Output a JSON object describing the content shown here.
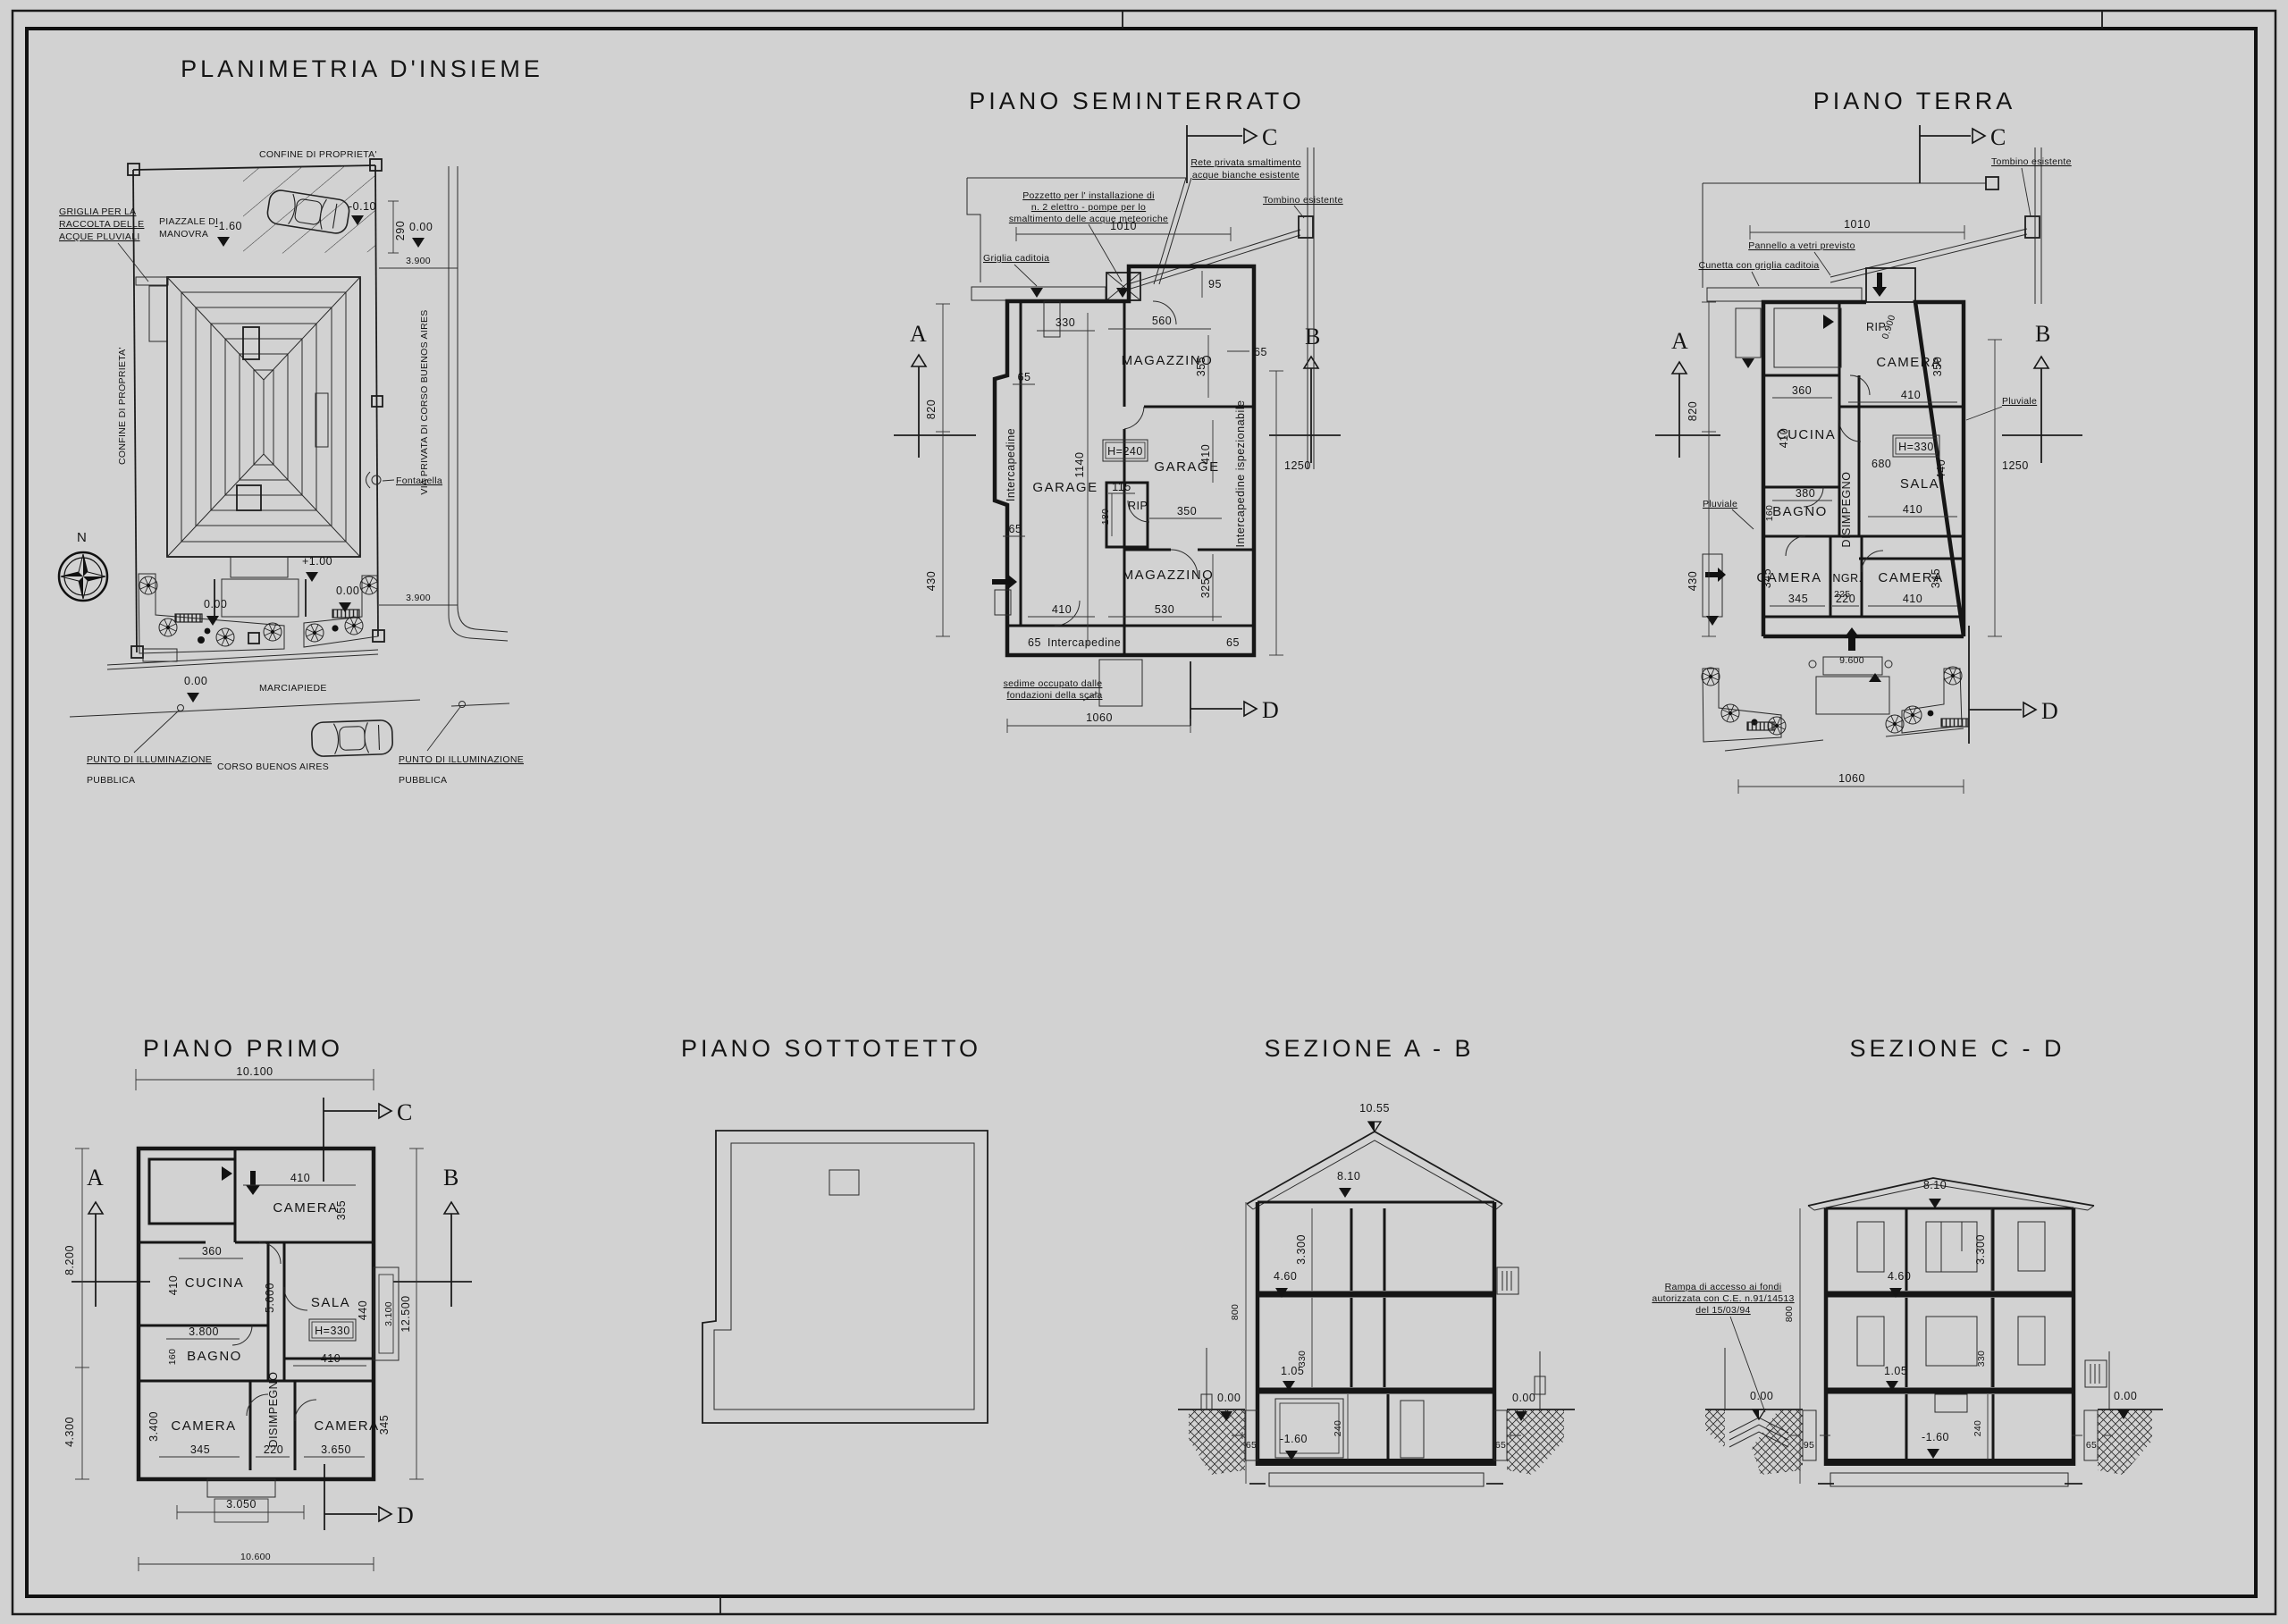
{
  "sheet": {
    "background": "#d2d2d2",
    "ink": "#1a1a1a"
  },
  "site": {
    "title": "PLANIMETRIA D'INSIEME",
    "north": "N",
    "sec": {},
    "notes": {
      "griglia1": "GRIGLIA PER LA",
      "griglia2": "RACCOLTA DELLE",
      "griglia3": "ACQUE PLUVIALI",
      "confine_top": "CONFINE DI PROPRIETA'",
      "confine_left": "CONFINE DI PROPRIETA'",
      "piazzale1": "PIAZZALE DI",
      "piazzale2": "MANOVRA",
      "via_privata": "VIA PRIVATA DI CORSO BUENOS AIRES",
      "fontanella": "Fontanella",
      "marciapiede": "MARCIAPIEDE",
      "corso": "CORSO BUENOS AIRES",
      "punto_ill": "PUNTO DI ILLUMINAZIONE",
      "pubblica": "PUBBLICA"
    },
    "levels": {
      "m160": "-1.60",
      "m010": "-0.10",
      "zero": "0.00",
      "p100": "+1.00"
    },
    "dims": {
      "d290": "290",
      "d3900": "3.900"
    }
  },
  "basement": {
    "title": "PIANO SEMINTERRATO",
    "sec": {
      "a": "A",
      "b": "B",
      "c": "C",
      "d": "D"
    },
    "rooms": {
      "garage1": "GARAGE",
      "garage2": "GARAGE",
      "magazzino1": "MAGAZZINO",
      "magazzino2": "MAGAZZINO",
      "rip": "RIP.",
      "h": "H=240"
    },
    "notes": {
      "rete1": "Rete privata smaltimento",
      "rete2": "acque bianche esistente",
      "pozzetto1": "Pozzetto per l' installazione di",
      "pozzetto2": "n. 2 elettro - pompe per lo",
      "pozzetto3": "smaltimento delle acque meteoriche",
      "tombino": "Tombino esistente",
      "griglia": "Griglia caditoia",
      "sedime1": "sedime occupato dalle",
      "sedime2": "fondazioni della scala",
      "intercapedine": "Intercapedine",
      "intercapedine_isp": "Intercapedine ispezionabile"
    },
    "dims": {
      "d1010": "1010",
      "d95": "95",
      "d330": "330",
      "d560": "560",
      "d65": "65",
      "d355": "355",
      "d820": "820",
      "d430": "430",
      "d1140": "1140",
      "d410": "410",
      "d115": "115",
      "d180": "180",
      "d350": "350",
      "d325": "325",
      "d530": "530",
      "d1250": "1250",
      "d1060": "1060"
    }
  },
  "ground": {
    "title": "PIANO TERRA",
    "sec": {
      "a": "A",
      "b": "B",
      "c": "C",
      "d": "D"
    },
    "rooms": {
      "rip": "RIP.",
      "camera1": "CAMERA",
      "cucina": "CUCINA",
      "sala": "SALA",
      "bagno": "BAGNO",
      "disimpegno": "DISIMPEGNO",
      "camera2": "CAMERA",
      "ingr": "INGR.",
      "camera3": "CAMERA",
      "h": "H=330"
    },
    "notes": {
      "tombino": "Tombino esistente",
      "pannello": "Pannello a vetri previsto",
      "cunetta": "Cunetta con griglia caditoia",
      "pluviale": "Pluviale"
    },
    "dims": {
      "d1010": "1010",
      "d0900": "0.900",
      "d350": "350",
      "d360": "360",
      "d410": "410",
      "d680": "680",
      "d440": "440",
      "d1250": "1250",
      "d380": "380",
      "d160": "160",
      "d345": "345",
      "d225": "225",
      "d220": "220",
      "d9600": "9.600",
      "d1060": "1060",
      "d820": "820",
      "d430": "430"
    }
  },
  "first": {
    "title": "PIANO PRIMO",
    "sec": {
      "a": "A",
      "b": "B",
      "c": "C",
      "d": "D"
    },
    "rooms": {
      "camera1": "CAMERA",
      "cucina": "CUCINA",
      "sala": "SALA",
      "bagno": "BAGNO",
      "disimpegno": "DISIMPEGNO",
      "camera2": "CAMERA",
      "camera3": "CAMERA",
      "h": "H=330"
    },
    "dims": {
      "d10100": "10.100",
      "d8200": "8.200",
      "d4300": "4.300",
      "d410": "410",
      "d355": "355",
      "d360": "360",
      "d5600": "5.600",
      "d440": "440",
      "d3100": "3.100",
      "d12500": "12.500",
      "d3800": "3.800",
      "d160": "160",
      "d3400": "3.400",
      "d345": "345",
      "d220": "220",
      "d3650": "3.650",
      "d3050": "3.050",
      "d10600": "10.600"
    }
  },
  "attic": {
    "title": "PIANO SOTTOTETTO"
  },
  "sectionAB": {
    "title": "SEZIONE A - B",
    "levels": {
      "l1055": "10.55",
      "l810": "8.10",
      "l460": "4.60",
      "l105": "1.05",
      "l000": "0.00",
      "lm160": "-1.60"
    },
    "dims": {
      "d3300": "3.300",
      "d800": "800",
      "d330": "330",
      "d240": "240",
      "d65": "65"
    }
  },
  "sectionCD": {
    "title": "SEZIONE C - D",
    "levels": {
      "l810": "8.10",
      "l460": "4.60",
      "l105": "1.05",
      "l000": "0.00",
      "lm160": "-1.60"
    },
    "dims": {
      "d3300": "3.300",
      "d800": "800",
      "d330": "330",
      "d240": "240",
      "d95": "95",
      "d65": "65"
    },
    "notes": {
      "rampa1": "Rampa di accesso ai fondi",
      "rampa2": "autorizzata con C.E. n.91/14513",
      "rampa3": "del 15/03/94"
    }
  }
}
